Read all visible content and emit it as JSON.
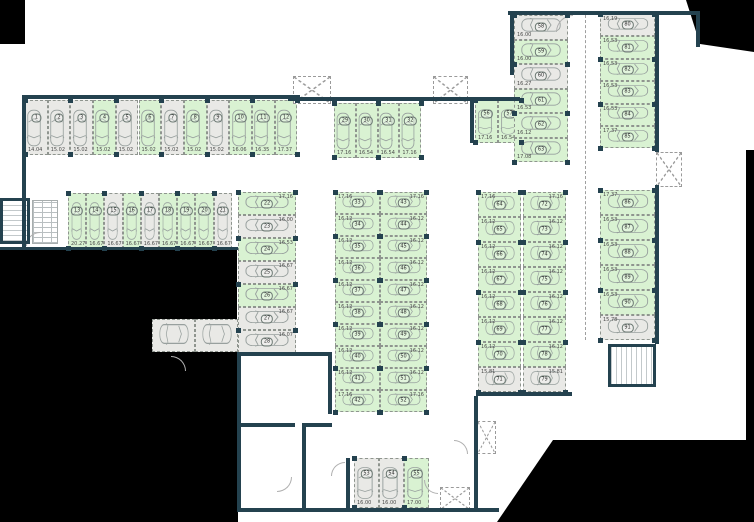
{
  "title": "parking-level-floor-plan",
  "colors": {
    "available_fill": "#d9f2d2",
    "occupied_fill": "#e9e9e6",
    "wall": "#24424f",
    "outside_mask": "#000000",
    "car_outline": "#98a09e"
  },
  "plan": {
    "groups": [
      {
        "id": "row-top-left",
        "x": 25,
        "y": 100,
        "dir": "row",
        "cw": 22.7,
        "ch": 55,
        "orient": "v",
        "areaPos": "b",
        "spaces": [
          {
            "n": "1",
            "a": "14.04",
            "s": "o"
          },
          {
            "n": "2",
            "a": "15.02",
            "s": "o"
          },
          {
            "n": "3",
            "a": "15.02",
            "s": "o"
          },
          {
            "n": "4",
            "a": "15.02",
            "s": "f"
          },
          {
            "n": "5",
            "a": "15.02",
            "s": "o"
          },
          {
            "n": "6",
            "a": "15.02",
            "s": "f"
          },
          {
            "n": "7",
            "a": "15.02",
            "s": "o"
          },
          {
            "n": "8",
            "a": "15.02",
            "s": "f"
          },
          {
            "n": "9",
            "a": "15.02",
            "s": "o"
          },
          {
            "n": "10",
            "a": "16.06",
            "s": "f"
          },
          {
            "n": "11",
            "a": "16.35",
            "s": "f"
          },
          {
            "n": "12",
            "a": "17.37",
            "s": "f"
          }
        ]
      },
      {
        "id": "row-second",
        "x": 68,
        "y": 193,
        "dir": "row",
        "cw": 18.2,
        "ch": 56,
        "orient": "v",
        "areaPos": "b",
        "spaces": [
          {
            "n": "13",
            "a": "20.27",
            "s": "f"
          },
          {
            "n": "14",
            "a": "16.67",
            "s": "f"
          },
          {
            "n": "15",
            "a": "16.67",
            "s": "o"
          },
          {
            "n": "16",
            "a": "16.67",
            "s": "f"
          },
          {
            "n": "17",
            "a": "16.67",
            "s": "o"
          },
          {
            "n": "18",
            "a": "16.67",
            "s": "f"
          },
          {
            "n": "19",
            "a": "16.67",
            "s": "f"
          },
          {
            "n": "20",
            "a": "16.67",
            "s": "f"
          },
          {
            "n": "21",
            "a": "16.67",
            "s": "o"
          }
        ]
      },
      {
        "id": "col-left-center",
        "x": 238,
        "y": 192,
        "dir": "col",
        "cw": 58,
        "ch": 23,
        "orient": "h",
        "areaPos": "tr",
        "spaces": [
          {
            "n": "22",
            "a": "17.16",
            "s": "f"
          },
          {
            "n": "23",
            "a": "16.00",
            "s": "o"
          },
          {
            "n": "24",
            "a": "16.53",
            "s": "f"
          },
          {
            "n": "25",
            "a": "16.67",
            "s": "o"
          },
          {
            "n": "26",
            "a": "16.67",
            "s": "f"
          },
          {
            "n": "27",
            "a": "16.67",
            "s": "o"
          },
          {
            "n": "28",
            "a": "16.07",
            "s": "o"
          }
        ]
      },
      {
        "id": "row-mid-top",
        "x": 334,
        "y": 103,
        "dir": "row",
        "cw": 21.8,
        "ch": 55,
        "orient": "v",
        "areaPos": "b",
        "spaces": [
          {
            "n": "29",
            "a": "17.16",
            "s": "f"
          },
          {
            "n": "30",
            "a": "16.54",
            "s": "f"
          },
          {
            "n": "31",
            "a": "16.54",
            "s": "f"
          },
          {
            "n": "32",
            "a": "17.16",
            "s": "f"
          }
        ]
      },
      {
        "id": "row-56-57",
        "x": 475,
        "y": 100,
        "dir": "row",
        "cw": 23,
        "ch": 43,
        "orient": "v",
        "areaPos": "b",
        "spaces": [
          {
            "n": "56",
            "a": "17.16",
            "s": "f"
          },
          {
            "n": "57",
            "a": "16.54",
            "s": "f"
          }
        ]
      },
      {
        "id": "col-topright-inner",
        "x": 514,
        "y": 15,
        "dir": "col",
        "cw": 54,
        "ch": 24.5,
        "orient": "h",
        "areaPos": "bl",
        "spaces": [
          {
            "n": "58",
            "a": "16.00",
            "s": "o"
          },
          {
            "n": "59",
            "a": "16.00",
            "s": "f"
          },
          {
            "n": "60",
            "a": "16.27",
            "s": "o"
          },
          {
            "n": "61",
            "a": "16.53",
            "s": "f"
          },
          {
            "n": "62",
            "a": "16.12",
            "s": "f"
          },
          {
            "n": "63",
            "a": "17.08",
            "s": "f"
          }
        ]
      },
      {
        "id": "col-topright-outer",
        "x": 600,
        "y": 14,
        "dir": "col",
        "cw": 55,
        "ch": 22.4,
        "orient": "h",
        "areaPos": "tl",
        "spaces": [
          {
            "n": "80",
            "a": "16.19",
            "s": "o"
          },
          {
            "n": "81",
            "a": "16.53",
            "s": "f"
          },
          {
            "n": "82",
            "a": "16.53",
            "s": "f"
          },
          {
            "n": "83",
            "a": "16.53",
            "s": "f"
          },
          {
            "n": "84",
            "a": "16.53",
            "s": "f"
          },
          {
            "n": "85",
            "a": "17.37",
            "s": "f"
          }
        ]
      },
      {
        "id": "col-center-left",
        "x": 335,
        "y": 192,
        "dir": "col",
        "cw": 45,
        "ch": 22,
        "orient": "h",
        "areaPos": "tl",
        "spaces": [
          {
            "n": "33",
            "a": "17.16",
            "s": "f"
          },
          {
            "n": "34",
            "a": "16.12",
            "s": "f"
          },
          {
            "n": "35",
            "a": "16.12",
            "s": "f"
          },
          {
            "n": "36",
            "a": "16.12",
            "s": "f"
          },
          {
            "n": "37",
            "a": "16.12",
            "s": "f"
          },
          {
            "n": "38",
            "a": "16.12",
            "s": "f"
          },
          {
            "n": "39",
            "a": "16.12",
            "s": "f"
          },
          {
            "n": "40",
            "a": "16.12",
            "s": "f"
          },
          {
            "n": "41",
            "a": "16.12",
            "s": "f"
          },
          {
            "n": "42",
            "a": "17.16",
            "s": "f"
          }
        ]
      },
      {
        "id": "col-center-right",
        "x": 380,
        "y": 192,
        "dir": "col",
        "cw": 47,
        "ch": 22,
        "orient": "h",
        "areaPos": "tr",
        "spaces": [
          {
            "n": "43",
            "a": "17.16",
            "s": "f"
          },
          {
            "n": "44",
            "a": "16.12",
            "s": "f"
          },
          {
            "n": "45",
            "a": "16.12",
            "s": "f"
          },
          {
            "n": "46",
            "a": "16.12",
            "s": "f"
          },
          {
            "n": "47",
            "a": "16.12",
            "s": "f"
          },
          {
            "n": "48",
            "a": "16.12",
            "s": "f"
          },
          {
            "n": "49",
            "a": "16.12",
            "s": "f"
          },
          {
            "n": "50",
            "a": "16.12",
            "s": "f"
          },
          {
            "n": "51",
            "a": "16.12",
            "s": "f"
          },
          {
            "n": "52",
            "a": "17.16",
            "s": "f"
          }
        ]
      },
      {
        "id": "col-right-inner",
        "x": 478,
        "y": 192,
        "dir": "col",
        "cw": 43,
        "ch": 25,
        "orient": "h",
        "areaPos": "tl",
        "spaces": [
          {
            "n": "64",
            "a": "17.16",
            "s": "f"
          },
          {
            "n": "65",
            "a": "16.12",
            "s": "f"
          },
          {
            "n": "66",
            "a": "16.12",
            "s": "f"
          },
          {
            "n": "67",
            "a": "16.12",
            "s": "f"
          },
          {
            "n": "68",
            "a": "16.12",
            "s": "f"
          },
          {
            "n": "69",
            "a": "16.12",
            "s": "f"
          },
          {
            "n": "70",
            "a": "16.12",
            "s": "f"
          },
          {
            "n": "71",
            "a": "15.81",
            "s": "o"
          }
        ]
      },
      {
        "id": "col-right-inner-2",
        "x": 523,
        "y": 192,
        "dir": "col",
        "cw": 43,
        "ch": 25,
        "orient": "h",
        "areaPos": "tr",
        "spaces": [
          {
            "n": "72",
            "a": "17.16",
            "s": "f"
          },
          {
            "n": "73",
            "a": "16.12",
            "s": "f"
          },
          {
            "n": "74",
            "a": "16.12",
            "s": "f"
          },
          {
            "n": "75",
            "a": "16.12",
            "s": "f"
          },
          {
            "n": "76",
            "a": "16.12",
            "s": "f"
          },
          {
            "n": "77",
            "a": "16.12",
            "s": "f"
          },
          {
            "n": "78",
            "a": "16.12",
            "s": "f"
          },
          {
            "n": "79",
            "a": "15.81",
            "s": "o"
          }
        ]
      },
      {
        "id": "col-right-outer",
        "x": 600,
        "y": 190,
        "dir": "col",
        "cw": 55,
        "ch": 25,
        "orient": "h",
        "areaPos": "tl",
        "spaces": [
          {
            "n": "86",
            "a": "17.37",
            "s": "f"
          },
          {
            "n": "87",
            "a": "16.53",
            "s": "f"
          },
          {
            "n": "88",
            "a": "16.53",
            "s": "f"
          },
          {
            "n": "89",
            "a": "16.53",
            "s": "f"
          },
          {
            "n": "90",
            "a": "16.53",
            "s": "f"
          },
          {
            "n": "91",
            "a": "15.78",
            "s": "o"
          }
        ]
      },
      {
        "id": "row-bottom",
        "x": 354,
        "y": 458,
        "dir": "row",
        "cw": 25,
        "ch": 50,
        "orient": "v",
        "areaPos": "b",
        "spaces": [
          {
            "n": "53",
            "a": "16.00",
            "s": "o"
          },
          {
            "n": "54",
            "a": "16.00",
            "s": "o"
          },
          {
            "n": "55",
            "a": "17.00",
            "s": "f"
          }
        ]
      },
      {
        "id": "row-aux",
        "x": 152,
        "y": 319,
        "dir": "row",
        "cw": 43,
        "ch": 33,
        "orient": "h",
        "areaPos": "b",
        "spaces": [
          {
            "n": "",
            "a": "",
            "s": "o"
          },
          {
            "n": "",
            "a": "",
            "s": "o"
          }
        ]
      }
    ],
    "walls": [
      [
        22,
        95,
        278,
        4
      ],
      [
        22,
        95,
        4,
        152
      ],
      [
        288,
        97,
        188,
        4
      ],
      [
        470,
        97,
        50,
        4
      ],
      [
        470,
        97,
        4,
        46
      ],
      [
        508,
        11,
        192,
        4
      ],
      [
        696,
        11,
        4,
        36
      ],
      [
        510,
        15,
        4,
        60
      ],
      [
        655,
        11,
        4,
        141
      ],
      [
        655,
        185,
        4,
        159
      ],
      [
        476,
        392,
        96,
        4
      ],
      [
        474,
        396,
        4,
        114
      ],
      [
        237,
        508,
        262,
        4
      ],
      [
        237,
        352,
        4,
        158
      ],
      [
        237,
        352,
        95,
        4
      ],
      [
        328,
        352,
        4,
        62
      ],
      [
        237,
        423,
        58,
        4
      ],
      [
        302,
        423,
        30,
        4
      ],
      [
        302,
        427,
        4,
        83
      ],
      [
        346,
        458,
        4,
        52
      ],
      [
        0,
        247,
        238,
        3
      ]
    ],
    "masks": [
      {
        "t": "r",
        "x": 0,
        "y": 0,
        "w": 25,
        "h": 44
      },
      {
        "t": "p",
        "pts": [
          [
            686,
            0
          ],
          [
            754,
            0
          ],
          [
            754,
            52
          ],
          [
            700,
            44
          ]
        ]
      },
      {
        "t": "r",
        "x": 746,
        "y": 150,
        "w": 8,
        "h": 292
      },
      {
        "t": "p",
        "pts": [
          [
            497,
            522
          ],
          [
            553,
            440
          ],
          [
            754,
            440
          ],
          [
            754,
            522
          ]
        ]
      },
      {
        "t": "r",
        "x": 0,
        "y": 250,
        "w": 237,
        "h": 69
      },
      {
        "t": "r",
        "x": 0,
        "y": 319,
        "w": 152,
        "h": 203
      },
      {
        "t": "r",
        "x": 0,
        "y": 352,
        "w": 238,
        "h": 170
      }
    ],
    "xboxes": [
      {
        "x": 293,
        "y": 76,
        "w": 36,
        "h": 26
      },
      {
        "x": 433,
        "y": 76,
        "w": 33,
        "h": 26
      },
      {
        "x": 656,
        "y": 152,
        "w": 24,
        "h": 33
      },
      {
        "x": 477,
        "y": 421,
        "w": 17,
        "h": 31
      },
      {
        "x": 440,
        "y": 487,
        "w": 28,
        "h": 21
      }
    ],
    "lanes": [
      {
        "x": 585,
        "y": 15,
        "h": 325
      }
    ],
    "doors": [
      {
        "x": 556,
        "y": 15,
        "r": 16,
        "rot": 0
      },
      {
        "x": 186,
        "y": 356,
        "r": 14,
        "rot": 90
      },
      {
        "x": 292,
        "y": 492,
        "r": 14,
        "rot": 180
      },
      {
        "x": 331,
        "y": 462,
        "r": 13,
        "rot": 0
      },
      {
        "x": 424,
        "y": 494,
        "r": 13,
        "rot": 270
      },
      {
        "x": 26,
        "y": 232,
        "r": 13,
        "rot": 0
      },
      {
        "x": 468,
        "y": 440,
        "r": 13,
        "rot": 90
      }
    ],
    "stairs": [
      {
        "x": 0,
        "y": 198,
        "w": 30,
        "h": 46,
        "treads": "h"
      },
      {
        "x": 608,
        "y": 344,
        "w": 48,
        "h": 43,
        "treads": "v"
      }
    ],
    "hatch": {
      "x": 32,
      "y": 200,
      "w": 26,
      "h": 44
    }
  }
}
